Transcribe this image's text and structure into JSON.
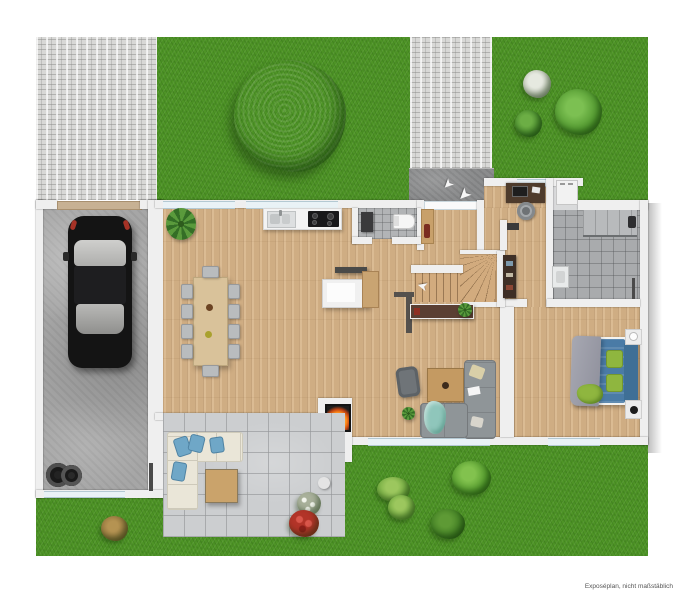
{
  "meta": {
    "disclaimer": "Exposéplan, nicht maßstäblich"
  },
  "icons": {
    "direction_arrow": "➤",
    "stair_arrow": "➤"
  },
  "colors": {
    "grass": "#4e9426",
    "wood_floor": "#d7b488",
    "paver": "#d8d8d6",
    "concrete": "#a6a6a6",
    "entry_concrete": "#8b8c8d",
    "patio_tile": "#ccced0",
    "bath_tile": "#a9abad",
    "wall": "#efefef",
    "car": "#141414",
    "sofa_gray": "#8f9598",
    "sofa_cream": "#eae6d8",
    "bed_blue": "#4a7ba6",
    "headboard_blue": "#3f6f96",
    "pillow_green": "#8fb63f",
    "accent_teal": "#8fc6bb",
    "fire_orange": "#ff8c1a",
    "text": "#555555"
  }
}
